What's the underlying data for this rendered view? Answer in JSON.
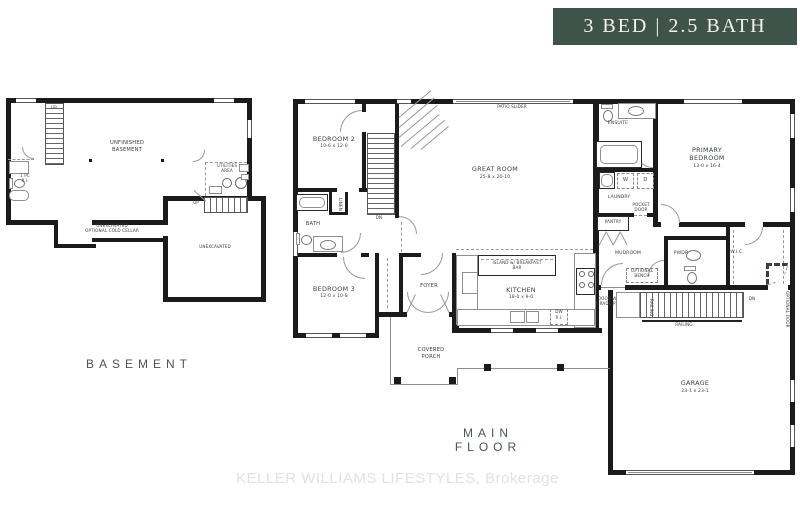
{
  "banner": {
    "label": "3 BED | 2.5 BATH"
  },
  "colors": {
    "banner_bg": "#3E5349",
    "banner_text": "#F3F2ED",
    "wall": "#1B1B1B",
    "label_text": "#3A3F42",
    "title_text": "#4A5558",
    "watermark_text": "#E2E2E2"
  },
  "basement": {
    "title": "BASEMENT",
    "unfinished_l1": "UNFINISHED",
    "unfinished_l2": "BASEMENT",
    "stairs_top_up": "UP",
    "stairs_right_up": "UP",
    "one_pc_l1": "1 PC",
    "one_pc_l2": "R.I.",
    "utilities_l1": "UTILITIES",
    "utilities_l2": "AREA",
    "cold_cellar_l1": "UNEXCAVATED",
    "cold_cellar_l2": "OPTIONAL COLD CELLAR",
    "unexcavated": "UNEXCAVATED"
  },
  "main": {
    "title": "MAIN FLOOR",
    "bedroom2": "BEDROOM 2",
    "bedroom2_dims": "10-6 x 12-0",
    "bath": "BATH",
    "linen": "LINEN",
    "bedroom3": "BEDROOM 3",
    "bedroom3_dims": "12-0 x 10-8",
    "stairs_dn": "DN",
    "patio_slider": "PATIO SLIDER",
    "great_room": "GREAT ROOM",
    "great_room_dims": "25-8 x 20-10",
    "ensuite": "ENSUITE",
    "primary_l1": "PRIMARY",
    "primary_l2": "BEDROOM",
    "primary_dims": "13-0 x 16-4",
    "laundry": "LAUNDRY",
    "washer": "W",
    "dryer": "D",
    "pocket_door_l1": "POCKET",
    "pocket_door_l2": "DOOR",
    "pantry": "PANTRY",
    "mudroom": "MUDROOM",
    "pwdr": "PWDR",
    "wic": "W.I.C.",
    "foyer": "FOYER",
    "kitchen": "KITCHEN",
    "kitchen_dims": "18-0 x 9-0",
    "island_l1": "ISLAND w/ BREAKFAST",
    "island_l2": "BAR",
    "dw_l1": "DW",
    "dw_l2": "R.I.",
    "covered_porch_l1": "COVERED",
    "covered_porch_l2": "PORCH",
    "garage": "GARAGE",
    "garage_dims": "23-1 x 23-1",
    "garage_dn": "DN",
    "railing_h": "RAILING",
    "railing_v": "RAILING",
    "optional_door": "OPTIONAL DOOR",
    "optional_bench_l1": "OPTIONAL",
    "optional_bench_l2": "BENCH",
    "door_grade_l1": "DOOR WHERE",
    "door_grade_l2": "GRADE PERMITS"
  },
  "watermark": {
    "text": "KELLER WILLIAMS LIFESTYLES, Brokerage"
  }
}
